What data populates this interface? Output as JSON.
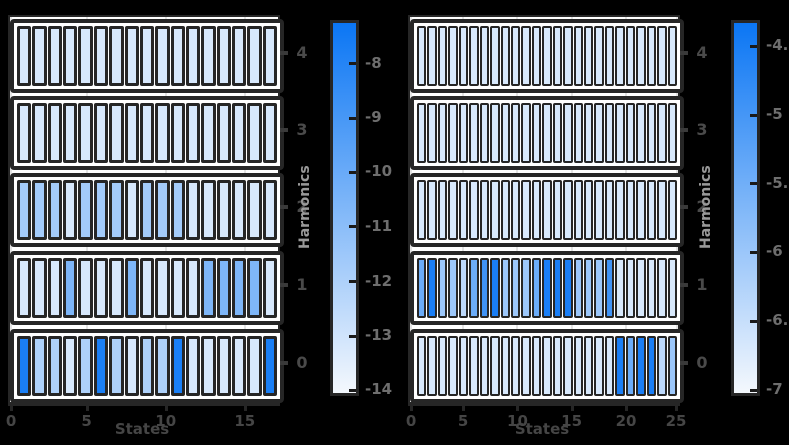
{
  "background": "#000000",
  "palette": {
    "panel_bg": "#ffffff",
    "grid": "#e4e4e4",
    "frame": "#262626",
    "tick_label_gray": "#4a4a4a",
    "colorbar_label_gray": "#6e6e6e",
    "axis_label_gray": "#9a9a9a",
    "cmap_low": "#f4f8fd",
    "cmap_high": "#0b76f4"
  },
  "chart_data": [
    {
      "type": "heatmap",
      "panel": "left",
      "xlabel": "States",
      "ylabel": "Harmonics",
      "x_ticks": [
        "0",
        "5",
        "10",
        "15"
      ],
      "x_tick_fracs": [
        0.004,
        0.286,
        0.581,
        0.876
      ],
      "n_states": 17,
      "y_categories": [
        "4",
        "3",
        "2",
        "1",
        "0"
      ],
      "grid": true,
      "colorbar": {
        "position": "right",
        "top_value": -7.25,
        "bottom_value": -14.05,
        "ticks": [
          "-8",
          "-9",
          "-10",
          "-11",
          "-12",
          "-13",
          "-14"
        ],
        "tick_fracs": [
          0.11,
          0.257,
          0.404,
          0.551,
          0.699,
          0.846,
          0.993
        ]
      },
      "values_note": "log-amplitude per state, estimated from colorbar shading",
      "rows": [
        {
          "harmonic": "4",
          "values": [
            -13.2,
            -13.2,
            -13.2,
            -13.2,
            -13.2,
            -13.2,
            -13.2,
            -13.2,
            -13.2,
            -13.2,
            -13.2,
            -13.2,
            -13.2,
            -13.2,
            -13.2,
            -13.2,
            -13.2
          ]
        },
        {
          "harmonic": "3",
          "values": [
            -13.2,
            -13.2,
            -13.2,
            -13.2,
            -13.2,
            -13.2,
            -13.2,
            -13.2,
            -13.2,
            -13.2,
            -13.2,
            -13.2,
            -13.2,
            -13.2,
            -13.2,
            -13.2,
            -13.2
          ]
        },
        {
          "harmonic": "2",
          "values": [
            -11.7,
            -11.7,
            -11.7,
            -13.2,
            -11.7,
            -11.7,
            -11.7,
            -13.2,
            -11.7,
            -11.7,
            -11.7,
            -13.2,
            -13.2,
            -13.2,
            -13.2,
            -13.2,
            -13.2
          ]
        },
        {
          "harmonic": "1",
          "values": [
            -13.2,
            -13.2,
            -13.2,
            -10.6,
            -13.2,
            -13.2,
            -13.2,
            -10.6,
            -13.2,
            -13.2,
            -13.2,
            -13.2,
            -10.6,
            -10.6,
            -10.6,
            -10.6,
            -13.2
          ]
        },
        {
          "harmonic": "0",
          "values": [
            -7.7,
            -12.0,
            -12.0,
            -13.2,
            -12.0,
            -7.7,
            -12.0,
            -13.2,
            -12.0,
            -12.0,
            -7.7,
            -13.2,
            -13.2,
            -13.2,
            -13.2,
            -13.2,
            -7.7
          ]
        }
      ]
    },
    {
      "type": "heatmap",
      "panel": "right",
      "xlabel": "States",
      "ylabel": "Harmonics",
      "x_ticks": [
        "0",
        "5",
        "10",
        "15",
        "20",
        "25"
      ],
      "x_tick_fracs": [
        0.004,
        0.198,
        0.401,
        0.603,
        0.806,
        0.996
      ],
      "n_states": 25,
      "y_categories": [
        "4",
        "3",
        "2",
        "1",
        "0"
      ],
      "grid": true,
      "colorbar": {
        "position": "right",
        "top_value": -4.33,
        "bottom_value": -7.02,
        "ticks": [
          "-4.5",
          "-5",
          "-5.5",
          "-6",
          "-6.5",
          "-7"
        ],
        "tick_fracs": [
          0.063,
          0.249,
          0.435,
          0.62,
          0.806,
          0.992
        ]
      },
      "values_note": "log-amplitude per state, estimated from colorbar shading",
      "rows": [
        {
          "harmonic": "4",
          "values": [
            -6.7,
            -6.7,
            -6.7,
            -6.7,
            -6.7,
            -6.7,
            -6.7,
            -6.7,
            -6.7,
            -6.7,
            -6.7,
            -6.7,
            -6.7,
            -6.7,
            -6.7,
            -6.7,
            -6.7,
            -6.7,
            -6.7,
            -6.7,
            -6.7,
            -6.7,
            -6.7,
            -6.7,
            -6.7
          ]
        },
        {
          "harmonic": "3",
          "values": [
            -6.7,
            -6.7,
            -6.7,
            -6.7,
            -6.7,
            -6.7,
            -6.7,
            -6.7,
            -6.7,
            -6.7,
            -6.7,
            -6.7,
            -6.7,
            -6.7,
            -6.7,
            -6.7,
            -6.7,
            -6.7,
            -6.7,
            -6.7,
            -6.7,
            -6.7,
            -6.7,
            -6.7,
            -6.7
          ]
        },
        {
          "harmonic": "2",
          "values": [
            -6.7,
            -6.7,
            -6.7,
            -6.7,
            -6.7,
            -6.7,
            -6.7,
            -6.7,
            -6.7,
            -6.7,
            -6.7,
            -6.7,
            -6.7,
            -6.7,
            -6.7,
            -6.7,
            -6.7,
            -6.7,
            -6.7,
            -6.7,
            -6.7,
            -6.7,
            -6.7,
            -6.7,
            -6.7
          ]
        },
        {
          "harmonic": "1",
          "values": [
            -5.44,
            -4.5,
            -6.0,
            -6.0,
            -6.38,
            -5.44,
            -4.93,
            -4.5,
            -6.0,
            -6.0,
            -6.0,
            -5.44,
            -4.5,
            -4.5,
            -4.5,
            -6.0,
            -6.0,
            -6.0,
            -4.93,
            -6.7,
            -6.7,
            -6.7,
            -6.7,
            -6.7,
            -6.7
          ]
        },
        {
          "harmonic": "0",
          "values": [
            -6.7,
            -6.7,
            -6.7,
            -6.7,
            -6.7,
            -6.7,
            -6.7,
            -6.7,
            -6.7,
            -6.7,
            -6.7,
            -6.7,
            -6.7,
            -6.7,
            -6.7,
            -6.7,
            -6.7,
            -6.7,
            -6.7,
            -4.5,
            -5.44,
            -4.5,
            -4.5,
            -6.38,
            -6.0
          ]
        }
      ]
    }
  ]
}
